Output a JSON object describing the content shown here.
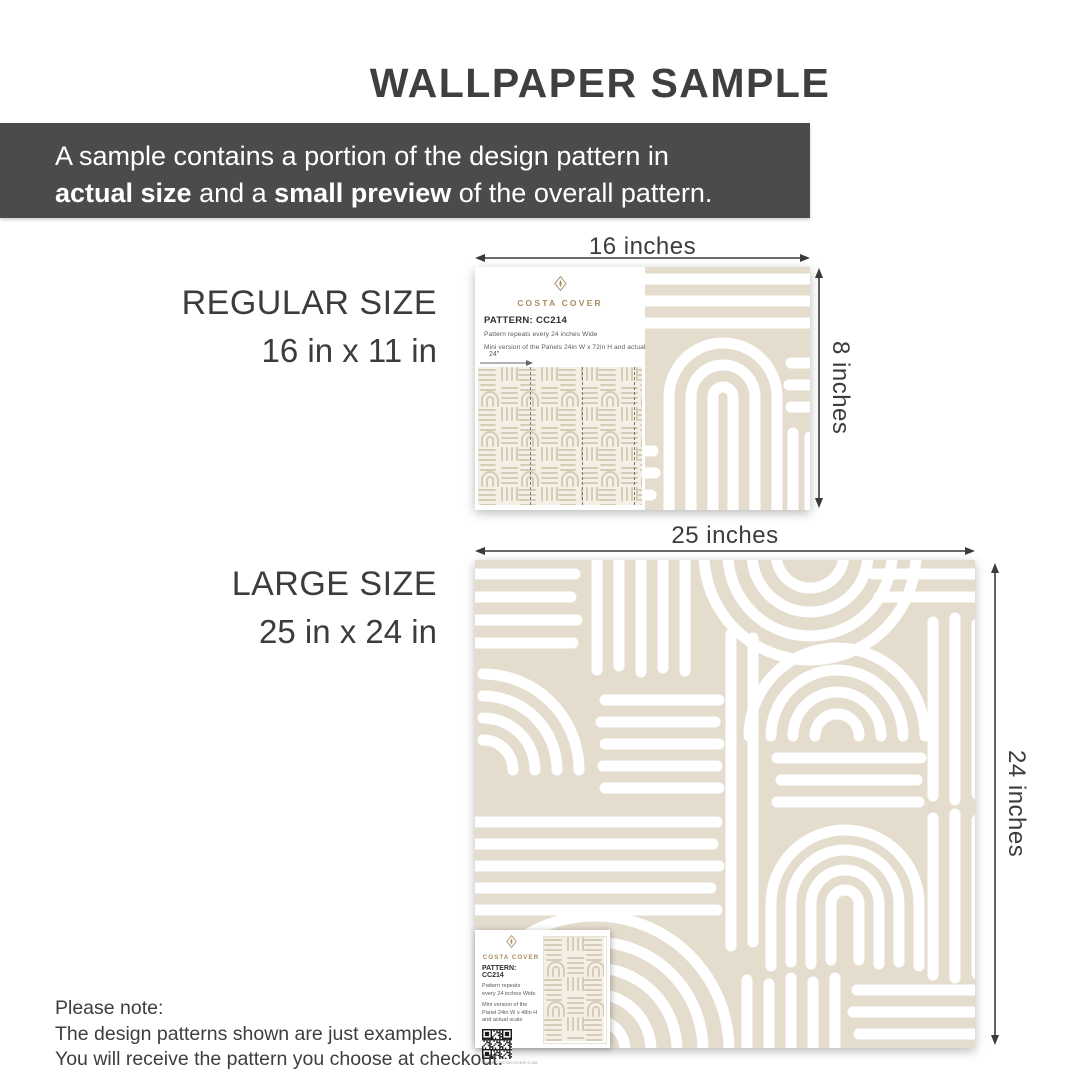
{
  "title": "WALLPAPER SAMPLE",
  "banner": {
    "line1": "A sample contains a portion of the design pattern in",
    "bold1": "actual size",
    "mid": " and a ",
    "bold2": "small preview",
    "end": " of the overall pattern."
  },
  "regular": {
    "size_name": "REGULAR SIZE",
    "size_dims": "16 in x 11 in",
    "width_label": "16 inches",
    "height_label": "8 inches",
    "card": {
      "brand": "COSTA COVER",
      "pattern_code": "PATTERN: CC214",
      "repeat_note": "Pattern repeats every 24 inches Wide",
      "mini_note": "Mini version of the Panels 24in W x 72in H and actual scale",
      "panel_width_label": "24\""
    }
  },
  "large": {
    "size_name": "LARGE SIZE",
    "size_dims": "25 in x 24 in",
    "width_label": "25 inches",
    "height_label": "24 inches",
    "card": {
      "brand": "COSTA COVER",
      "pattern_code": "PATTERN: CC214",
      "repeat_note_l1": "Pattern repeats",
      "repeat_note_l2": "every 24 inches Wide",
      "mini_note_l1": "Mini version of the",
      "mini_note_l2": "Panel 24in W x 48in H",
      "mini_note_l3": "and actual scale",
      "qr_caption": "WWW.COSTACOVER.COM"
    }
  },
  "note": {
    "title": "Please note:",
    "line1": "The design patterns shown are just examples.",
    "line2": "You will receive the pattern you choose at checkout."
  },
  "colors": {
    "pattern_beige": "#e4dccd",
    "banner_bg": "#4b4b4b",
    "text_dark": "#3d3d3d",
    "brand_gold": "#a98c5f"
  }
}
